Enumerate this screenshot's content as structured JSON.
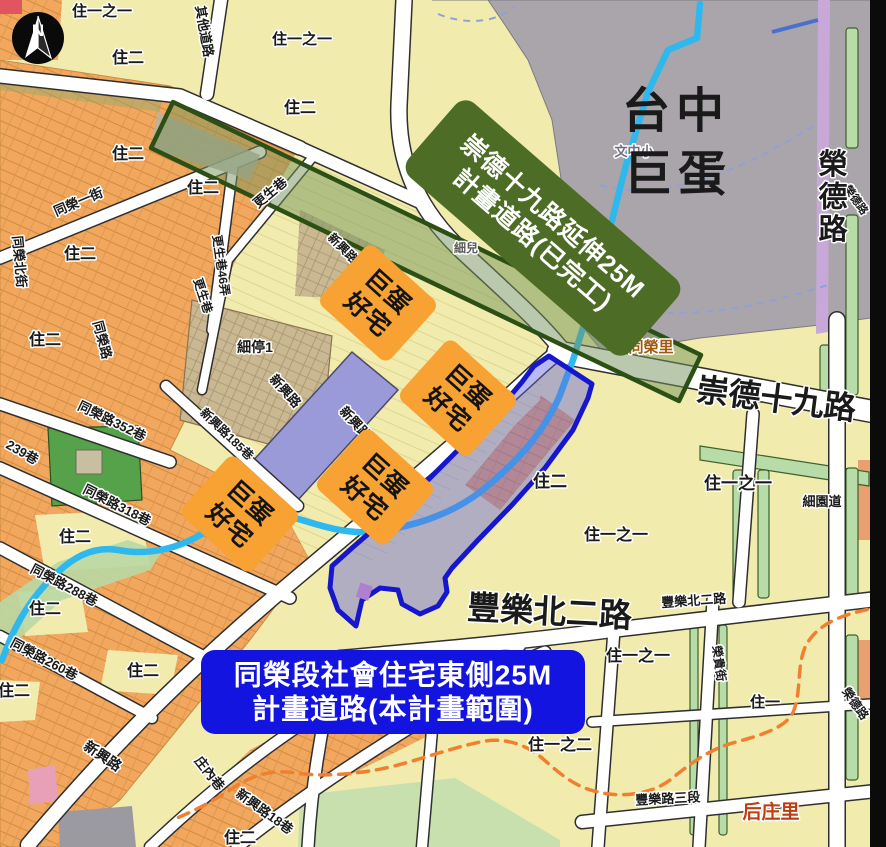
{
  "title": "台中巨蛋周邊計畫道路地圖",
  "compass": {
    "letter": "N"
  },
  "colors": {
    "zone_residential2": "#f2a75e",
    "zone_residential1": "#f1ecad",
    "dome_site_gray": "#a9a5aa",
    "corridor_green": "#4d6d27",
    "project_blue": "#1414e0",
    "housing_box_orange": "#f7a233",
    "stream_cyan": "#2eb8ee",
    "boundary_orange_dash": "#f08030",
    "park_green": "#55a24b",
    "parcel_lavender": "#9a9ad8",
    "parcel_tan": "#c9b891"
  },
  "plates": [
    {
      "name": "corridor-label-plate",
      "lines": [
        "崇德十九路延伸25M",
        "計畫道路(已完工)"
      ],
      "cx": 543,
      "cy": 228,
      "w": 294,
      "h": 98,
      "rot": 41,
      "bg": "#4d6d27",
      "fg": "#ffffff",
      "size": 25,
      "weight": 700,
      "rx": 14
    },
    {
      "name": "project-banner",
      "lines": [
        "同榮段社會住宅東側25M",
        "計畫道路(本計畫範圍)"
      ],
      "cx": 393,
      "cy": 692,
      "w": 384,
      "h": 84,
      "rot": 0,
      "bg": "#1414e0",
      "fg": "#ffffff",
      "size": 28,
      "weight": 700,
      "rx": 14
    },
    {
      "name": "dome-housing-box-1",
      "lines": [
        "巨蛋",
        "好宅"
      ],
      "cx": 378,
      "cy": 303,
      "w": 94,
      "h": 80,
      "rot": 42,
      "bg": "#f7a233",
      "fg": "#141414",
      "size": 25,
      "weight": 800,
      "rx": 9
    },
    {
      "name": "dome-housing-box-2",
      "lines": [
        "巨蛋",
        "好宅"
      ],
      "cx": 458,
      "cy": 398,
      "w": 94,
      "h": 80,
      "rot": 42,
      "bg": "#f7a233",
      "fg": "#141414",
      "size": 25,
      "weight": 800,
      "rx": 9
    },
    {
      "name": "dome-housing-box-3",
      "lines": [
        "巨蛋",
        "好宅"
      ],
      "cx": 375,
      "cy": 487,
      "w": 94,
      "h": 80,
      "rot": 42,
      "bg": "#f7a233",
      "fg": "#141414",
      "size": 25,
      "weight": 800,
      "rx": 9
    },
    {
      "name": "dome-housing-box-4",
      "lines": [
        "巨蛋",
        "好宅"
      ],
      "cx": 240,
      "cy": 514,
      "w": 94,
      "h": 80,
      "rot": 42,
      "bg": "#f7a233",
      "fg": "#141414",
      "size": 25,
      "weight": 800,
      "rx": 9
    }
  ],
  "map_labels": [
    {
      "name": "zone-label",
      "text": "住一之一",
      "x": 102,
      "y": 16,
      "size": 15
    },
    {
      "name": "zone-label",
      "text": "住二",
      "x": 128,
      "y": 63,
      "size": 16
    },
    {
      "name": "zone-label",
      "text": "住一之一",
      "x": 302,
      "y": 44,
      "size": 15
    },
    {
      "name": "zone-label",
      "text": "住二",
      "x": 300,
      "y": 113,
      "size": 16
    },
    {
      "name": "zone-label",
      "text": "住二",
      "x": 128,
      "y": 159,
      "size": 16
    },
    {
      "name": "zone-label",
      "text": "住二",
      "x": 203,
      "y": 193,
      "size": 16
    },
    {
      "name": "zone-label",
      "text": "住二",
      "x": 80,
      "y": 259,
      "size": 16
    },
    {
      "name": "zone-label",
      "text": "住二",
      "x": 45,
      "y": 345,
      "size": 16
    },
    {
      "name": "zone-label",
      "text": "住二",
      "x": 75,
      "y": 542,
      "size": 16
    },
    {
      "name": "zone-label",
      "text": "住二",
      "x": 45,
      "y": 614,
      "size": 16
    },
    {
      "name": "zone-label",
      "text": "住二",
      "x": 143,
      "y": 676,
      "size": 16
    },
    {
      "name": "zone-label",
      "text": "住二",
      "x": 14,
      "y": 696,
      "size": 16
    },
    {
      "name": "zone-label",
      "text": "住二",
      "x": 550,
      "y": 487,
      "size": 17
    },
    {
      "name": "zone-label",
      "text": "住二",
      "x": 240,
      "y": 843,
      "size": 16
    },
    {
      "name": "zone-label",
      "text": "住一之一",
      "x": 738,
      "y": 489,
      "size": 17
    },
    {
      "name": "zone-label",
      "text": "住一之一",
      "x": 616,
      "y": 540,
      "size": 16
    },
    {
      "name": "zone-label",
      "text": "住一之一",
      "x": 638,
      "y": 661,
      "size": 16
    },
    {
      "name": "zone-label",
      "text": "住一之二",
      "x": 560,
      "y": 750,
      "size": 16
    },
    {
      "name": "zone-label",
      "text": "住一",
      "x": 765,
      "y": 707,
      "size": 15
    },
    {
      "name": "street-label",
      "text": "其他道路",
      "x": 200,
      "y": 32,
      "size": 13,
      "rot": 80
    },
    {
      "name": "street-label",
      "text": "同榮一街",
      "x": 80,
      "y": 206,
      "size": 13,
      "rot": -23
    },
    {
      "name": "street-label",
      "text": "同榮北街",
      "x": 15,
      "y": 262,
      "size": 13,
      "rot": 85
    },
    {
      "name": "street-label",
      "text": "更生巷",
      "x": 273,
      "y": 196,
      "size": 13,
      "rot": -40
    },
    {
      "name": "street-label",
      "text": "更生巷46弄",
      "x": 217,
      "y": 266,
      "size": 12,
      "rot": 82
    },
    {
      "name": "street-label",
      "text": "更生巷",
      "x": 199,
      "y": 297,
      "size": 12,
      "rot": 72
    },
    {
      "name": "street-label",
      "text": "同榮路",
      "x": 98,
      "y": 341,
      "size": 13,
      "rot": 75
    },
    {
      "name": "street-label",
      "text": "同榮路352巷",
      "x": 110,
      "y": 425,
      "size": 13,
      "rot": 26
    },
    {
      "name": "street-label",
      "text": "239巷",
      "x": 20,
      "y": 456,
      "size": 13,
      "rot": 30
    },
    {
      "name": "street-label",
      "text": "同榮路318巷",
      "x": 115,
      "y": 509,
      "size": 13,
      "rot": 27
    },
    {
      "name": "street-label",
      "text": "同榮路288巷",
      "x": 62,
      "y": 589,
      "size": 13,
      "rot": 28
    },
    {
      "name": "street-label",
      "text": "同榮路260巷",
      "x": 42,
      "y": 663,
      "size": 13,
      "rot": 28
    },
    {
      "name": "street-label",
      "text": "新興路185巷",
      "x": 224,
      "y": 437,
      "size": 12,
      "rot": 44
    },
    {
      "name": "street-label",
      "text": "新興路",
      "x": 282,
      "y": 394,
      "size": 13,
      "rot": 48
    },
    {
      "name": "street-label",
      "text": "新興路",
      "x": 352,
      "y": 426,
      "size": 13,
      "rot": 48
    },
    {
      "name": "street-label",
      "text": "新興路",
      "x": 340,
      "y": 251,
      "size": 12,
      "rot": 45
    },
    {
      "name": "street-label",
      "text": "新興路",
      "x": 100,
      "y": 760,
      "size": 14,
      "rot": 34
    },
    {
      "name": "street-label",
      "text": "庄內巷",
      "x": 206,
      "y": 776,
      "size": 13,
      "rot": 52
    },
    {
      "name": "street-label",
      "text": "新興路18巷",
      "x": 262,
      "y": 815,
      "size": 13,
      "rot": 36
    },
    {
      "name": "facility-label",
      "text": "細停1",
      "x": 255,
      "y": 352,
      "size": 14
    },
    {
      "name": "facility-label",
      "text": "細兒",
      "x": 466,
      "y": 252,
      "size": 12,
      "color": "#5a5a5a"
    },
    {
      "name": "facility-label",
      "text": "文中小",
      "x": 634,
      "y": 156,
      "size": 13,
      "color": "#6e6e80"
    },
    {
      "name": "street-label",
      "text": "細園道",
      "x": 822,
      "y": 506,
      "size": 13
    },
    {
      "name": "street-label",
      "text": "豐樂北二路",
      "x": 694,
      "y": 605,
      "size": 13,
      "rot": -4
    },
    {
      "name": "street-label",
      "text": "榮貴街",
      "x": 715,
      "y": 664,
      "size": 12,
      "rot": 82
    },
    {
      "name": "street-label",
      "text": "豐樂路三段",
      "x": 668,
      "y": 803,
      "size": 13,
      "rot": -3
    },
    {
      "name": "street-label",
      "text": "榮德路",
      "x": 853,
      "y": 202,
      "size": 11,
      "rot": 55
    },
    {
      "name": "street-label",
      "text": "榮德路",
      "x": 852,
      "y": 706,
      "size": 12,
      "rot": 55
    },
    {
      "name": "district-label",
      "text": "同榮里",
      "x": 651,
      "y": 352,
      "size": 15,
      "color": "#a05a10",
      "weight": 700
    },
    {
      "name": "district-label",
      "text": "后庄里",
      "x": 771,
      "y": 818,
      "size": 19,
      "color": "#bf3d0e",
      "weight": 800
    },
    {
      "name": "dome-title",
      "text": "台中",
      "x": 676,
      "y": 127,
      "size": 48,
      "weight": 900,
      "ls": 6,
      "halo": false
    },
    {
      "name": "dome-title",
      "text": "巨蛋",
      "x": 678,
      "y": 190,
      "size": 48,
      "weight": 900,
      "ls": 6,
      "halo": false
    },
    {
      "name": "road-title",
      "text": "榮德路",
      "x": 833,
      "y": 174,
      "size": 29,
      "weight": 900,
      "vertical": true
    },
    {
      "name": "road-title",
      "text": "崇德十九路",
      "x": 775,
      "y": 410,
      "size": 32,
      "weight": 900,
      "rot": 7
    },
    {
      "name": "road-title",
      "text": "豐樂北二路",
      "x": 549,
      "y": 623,
      "size": 33,
      "weight": 900,
      "rot": 3
    }
  ]
}
